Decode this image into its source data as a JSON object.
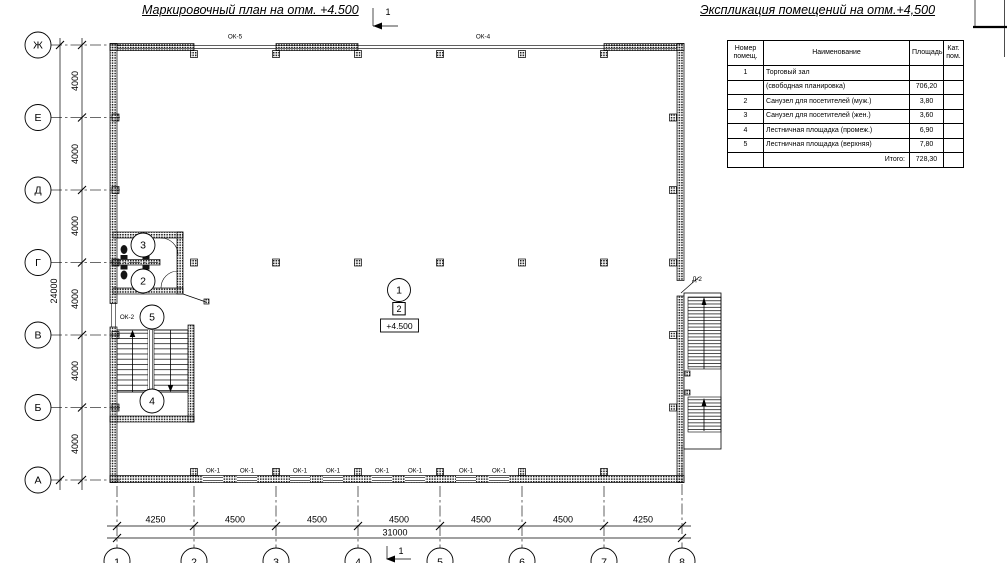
{
  "page": {
    "background": "#ffffff"
  },
  "titles": {
    "plan": "Маркировочный план на отм. +4.500",
    "schedule": "Экспликация помещений на отм.+4,500"
  },
  "section_marks": {
    "top": "1",
    "bottom": "1"
  },
  "schedule": {
    "headers": [
      "Номер помещ.",
      "Наименование",
      "Площадь",
      "Кат. пом."
    ],
    "rows": [
      {
        "num": "1",
        "name": "Торговый зал",
        "area": "",
        "cat": ""
      },
      {
        "num": "",
        "name": "(свободная планировка)",
        "area": "706,20",
        "cat": ""
      },
      {
        "num": "2",
        "name": "Санузел для посетителей (муж.)",
        "area": "3,80",
        "cat": ""
      },
      {
        "num": "3",
        "name": "Санузел для посетителей (жен.)",
        "area": "3,60",
        "cat": ""
      },
      {
        "num": "4",
        "name": "Лестничная площадка (промеж.)",
        "area": "6,90",
        "cat": ""
      },
      {
        "num": "5",
        "name": "Лестничная площадка (верхняя)",
        "area": "7,80",
        "cat": ""
      },
      {
        "num": "",
        "name": "Итого:",
        "area": "728,30",
        "cat": ""
      }
    ]
  },
  "grid": {
    "rows": [
      {
        "label": "Ж"
      },
      {
        "label": "Е"
      },
      {
        "label": "Д"
      },
      {
        "label": "Г"
      },
      {
        "label": "В"
      },
      {
        "label": "Б"
      },
      {
        "label": "А"
      }
    ],
    "cols": [
      {
        "label": "1"
      },
      {
        "label": "2"
      },
      {
        "label": "3"
      },
      {
        "label": "4"
      },
      {
        "label": "5"
      },
      {
        "label": "6"
      },
      {
        "label": "7"
      },
      {
        "label": "8"
      }
    ]
  },
  "dims": {
    "v_segments": [
      "4000",
      "4000",
      "4000",
      "4000",
      "4000",
      "4000"
    ],
    "v_total": "24000",
    "h_segments": [
      "4250",
      "4500",
      "4500",
      "4500",
      "4500",
      "4500",
      "4250"
    ],
    "h_total": "31000"
  },
  "windows": {
    "top": [
      "ОК-5",
      "ОК-4"
    ],
    "bottom": [
      "ОК-1",
      "ОК-1",
      "ОК-1",
      "ОК-1",
      "ОК-1",
      "ОК-1",
      "ОК-1",
      "ОК-1"
    ],
    "left": "ОК-2",
    "door": "Д-2"
  },
  "rooms": [
    {
      "n": "1"
    },
    {
      "n": "2"
    },
    {
      "n": "3"
    },
    {
      "n": "4"
    },
    {
      "n": "5"
    }
  ],
  "level_mark": {
    "storey": "2",
    "elevation": "+4.500"
  }
}
